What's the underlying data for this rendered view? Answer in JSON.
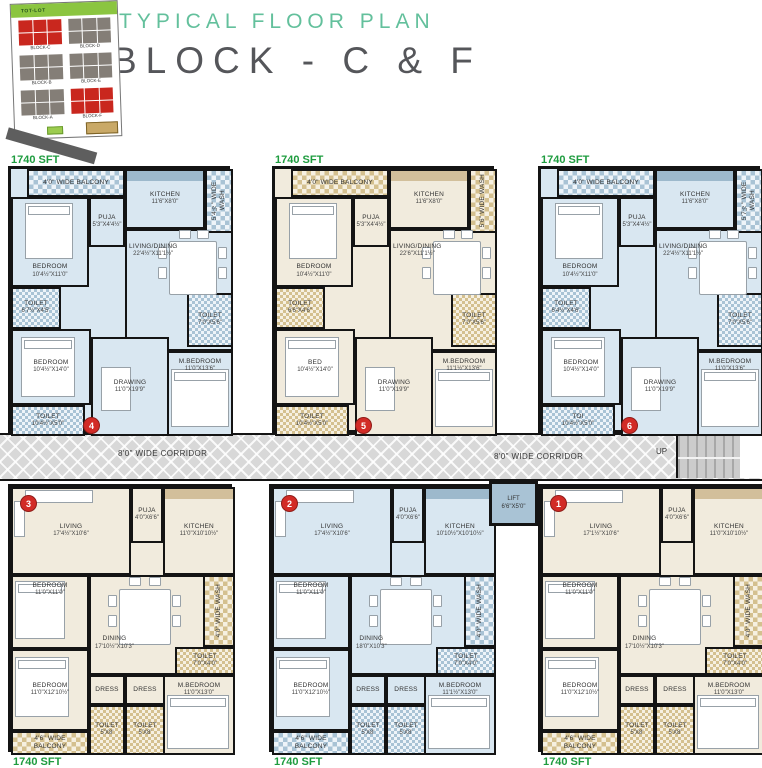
{
  "header": {
    "subtitle": "TYPICAL FLOOR PLAN",
    "title": "BLOCK - C & F"
  },
  "key_plan": {
    "tot_lot": "TOT-LOT",
    "blocks": [
      {
        "label": "BLOCK-C",
        "highlight": true
      },
      {
        "label": "BLOCK-D",
        "highlight": false
      },
      {
        "label": "BLOCK-B",
        "highlight": false
      },
      {
        "label": "BLOCK-E",
        "highlight": false
      },
      {
        "label": "BLOCK-A",
        "highlight": false
      },
      {
        "label": "BLOCK-F",
        "highlight": true
      }
    ]
  },
  "corridor": {
    "label_left": "8'0\" WIDE CORRIDOR",
    "label_right": "8'0\" WIDE CORRIDOR",
    "up": "UP",
    "lift_name": "LIFT",
    "lift_dims": "6'6\"X5'0\""
  },
  "colors": {
    "accent_teal": "#63c09c",
    "title_gray": "#55565a",
    "area_green": "#1e9c3f",
    "unit_red_badge": "#d22b26",
    "block_red": "#c9271e",
    "block_gray": "#847e77"
  },
  "units": [
    {
      "number": "4",
      "area": "1740 SFT",
      "scheme": "blue",
      "type": "top",
      "rooms": {
        "balcony": {
          "name": "4'0\" WIDE BALCONY"
        },
        "wash": {
          "name": "5'4½\" WIDE WASH"
        },
        "kitchen": {
          "name": "KITCHEN",
          "dims": "11'6\"X8'0\""
        },
        "puja": {
          "name": "PUJA",
          "dims": "5'3\"X4'4½\""
        },
        "bedroom1": {
          "name": "BEDROOM",
          "dims": "10'4½\"X11'0\""
        },
        "living": {
          "name": "LIVING/DINING",
          "dims": "22'4½\"X11'1½\""
        },
        "toilet1": {
          "name": "TOILET",
          "dims": "6'7½\"X4'5\""
        },
        "toilet2": {
          "name": "TOILET",
          "dims": "7'0\"X5'6\""
        },
        "bedroom2": {
          "name": "BEDROOM",
          "dims": "10'4½\"X14'0\""
        },
        "toilet3": {
          "name": "TOILET",
          "dims": "10'4½\"X5'0\""
        },
        "drawing": {
          "name": "DRAWING",
          "dims": "11'0\"X19'9\""
        },
        "mbedroom": {
          "name": "M.BEDROOM",
          "dims": "11'0\"X13'6\""
        }
      }
    },
    {
      "number": "5",
      "area": "1740 SFT",
      "scheme": "beige",
      "type": "top",
      "rooms": {
        "balcony": {
          "name": "4'0\" WIDE BALCONY"
        },
        "wash": {
          "name": "5'6\" WIDE WASH"
        },
        "kitchen": {
          "name": "KITCHEN",
          "dims": "11'6\"X8'0\""
        },
        "puja": {
          "name": "PUJA",
          "dims": "5'3\"X4'4½\""
        },
        "bedroom1": {
          "name": "BEDROOM",
          "dims": "10'4½\"X11'0\""
        },
        "living": {
          "name": "LIVING/DINING",
          "dims": "22'6\"X11'1½\""
        },
        "toilet1": {
          "name": "TOILET",
          "dims": "6'6\"X4'6\""
        },
        "toilet2": {
          "name": "TOILET",
          "dims": "7'0\"X5'6\""
        },
        "bedroom2": {
          "name": "BED",
          "dims": "10'4½\"X14'0\""
        },
        "toilet3": {
          "name": "TOILET",
          "dims": "10'4½\"X5'0\""
        },
        "drawing": {
          "name": "DRAWING",
          "dims": "11'0\"X19'9\""
        },
        "mbedroom": {
          "name": "M.BEDROOM",
          "dims": "11'1½\"X13'6\""
        }
      }
    },
    {
      "number": "6",
      "area": "1740 SFT",
      "scheme": "blue",
      "type": "top",
      "rooms": {
        "balcony": {
          "name": "4'0\" WIDE BALCONY"
        },
        "wash": {
          "name": "5'7½\" WIDE WASH"
        },
        "kitchen": {
          "name": "KITCHEN",
          "dims": "11'6\"X8'0\""
        },
        "puja": {
          "name": "PUJA",
          "dims": "5'3\"X4'4½\""
        },
        "bedroom1": {
          "name": "BEDROOM",
          "dims": "10'4½\"X11'0\""
        },
        "living": {
          "name": "LIVING/DINING",
          "dims": "22'4½\"X11'1½\""
        },
        "toilet1": {
          "name": "TOILET",
          "dims": "6'4½\"X4'6\""
        },
        "toilet2": {
          "name": "TOILET",
          "dims": "7'0\"X5'6\""
        },
        "bedroom2": {
          "name": "BEDROOM",
          "dims": "10'4½\"X14'0\""
        },
        "toilet3": {
          "name": "TOI",
          "dims": "10'4½\"X5'0\""
        },
        "drawing": {
          "name": "DRAWING",
          "dims": "11'0\"X19'9\""
        },
        "mbedroom": {
          "name": "M.BEDROOM",
          "dims": "11'0\"X13'6\""
        }
      }
    },
    {
      "number": "3",
      "area": "1740 SFT",
      "scheme": "beige",
      "type": "bottom",
      "rooms": {
        "living": {
          "name": "LIVING",
          "dims": "17'4½\"X10'6\""
        },
        "puja": {
          "name": "PUJA",
          "dims": "4'0\"X6'6\""
        },
        "kitchen": {
          "name": "KITCHEN",
          "dims": "11'0\"X10'10½\""
        },
        "bedroom1": {
          "name": "BEDROOM",
          "dims": "11'0\"X11'0\""
        },
        "dining": {
          "name": "DINING",
          "dims": "17'10½\"X10'3\""
        },
        "wash": {
          "name": "4'0\" WIDE WASH"
        },
        "toilet1": {
          "name": "TOILET",
          "dims": "7'0\"X4'0\""
        },
        "bedroom2": {
          "name": "BEDROOM",
          "dims": "11'0\"X12'10½\""
        },
        "dress1": {
          "name": "DRESS"
        },
        "dress2": {
          "name": "DRESS"
        },
        "toilet2": {
          "name": "TOILET",
          "dims": "5'X8'"
        },
        "toilet3": {
          "name": "TOILET",
          "dims": "5'X8'"
        },
        "mbedroom": {
          "name": "M.BEDROOM",
          "dims": "11'0\"X13'0\""
        },
        "balcony": {
          "name": "4'6\" WIDE BALCONY"
        }
      }
    },
    {
      "number": "2",
      "area": "1740 SFT",
      "scheme": "blue",
      "type": "bottom",
      "rooms": {
        "living": {
          "name": "LIVING",
          "dims": "17'4½\"X10'6\""
        },
        "puja": {
          "name": "PUJA",
          "dims": "4'0\"X6'6\""
        },
        "kitchen": {
          "name": "KITCHEN",
          "dims": "10'10½\"X10'10½\""
        },
        "bedroom1": {
          "name": "BEDROOM",
          "dims": "11'0\"X11'0\""
        },
        "dining": {
          "name": "DINING",
          "dims": "18'0\"X10'3\""
        },
        "wash": {
          "name": "4'0\" WIDE WASH"
        },
        "toilet1": {
          "name": "TOILET",
          "dims": "7'0\"X4'0\""
        },
        "bedroom2": {
          "name": "BEDROOM",
          "dims": "11'0\"X12'10½\""
        },
        "dress1": {
          "name": "DRESS"
        },
        "dress2": {
          "name": "DRESS"
        },
        "toilet2": {
          "name": "TOILET",
          "dims": "5'X8'"
        },
        "toilet3": {
          "name": "TOILET",
          "dims": "5'X8'"
        },
        "mbedroom": {
          "name": "M.BEDROOM",
          "dims": "11'1½\"X13'0\""
        },
        "balcony": {
          "name": "4'6\" WIDE BALCONY"
        }
      }
    },
    {
      "number": "1",
      "area": "1740 SFT",
      "scheme": "beige",
      "type": "bottom",
      "rooms": {
        "living": {
          "name": "LIVING",
          "dims": "17'1½\"X10'6\""
        },
        "puja": {
          "name": "PUJA",
          "dims": "4'0\"X6'6\""
        },
        "kitchen": {
          "name": "KITCHEN",
          "dims": "11'0\"X10'10½\""
        },
        "bedroom1": {
          "name": "BEDROOM",
          "dims": "11'0\"X11'0\""
        },
        "dining": {
          "name": "DINING",
          "dims": "17'10½\"X10'3\""
        },
        "wash": {
          "name": "4'0\" WIDE WASH"
        },
        "toilet1": {
          "name": "TOILET",
          "dims": "7'0\"X4'0\""
        },
        "bedroom2": {
          "name": "BEDROOM",
          "dims": "11'0\"X12'10½\""
        },
        "dress1": {
          "name": "DRESS"
        },
        "dress2": {
          "name": "DRESS"
        },
        "toilet2": {
          "name": "TOILET",
          "dims": "5'X8'"
        },
        "toilet3": {
          "name": "TOILET",
          "dims": "5'X8'"
        },
        "mbedroom": {
          "name": "M.BEDROOM",
          "dims": "11'0\"X13'0\""
        },
        "balcony": {
          "name": "4'6\" WIDE BALCONY"
        }
      }
    }
  ]
}
